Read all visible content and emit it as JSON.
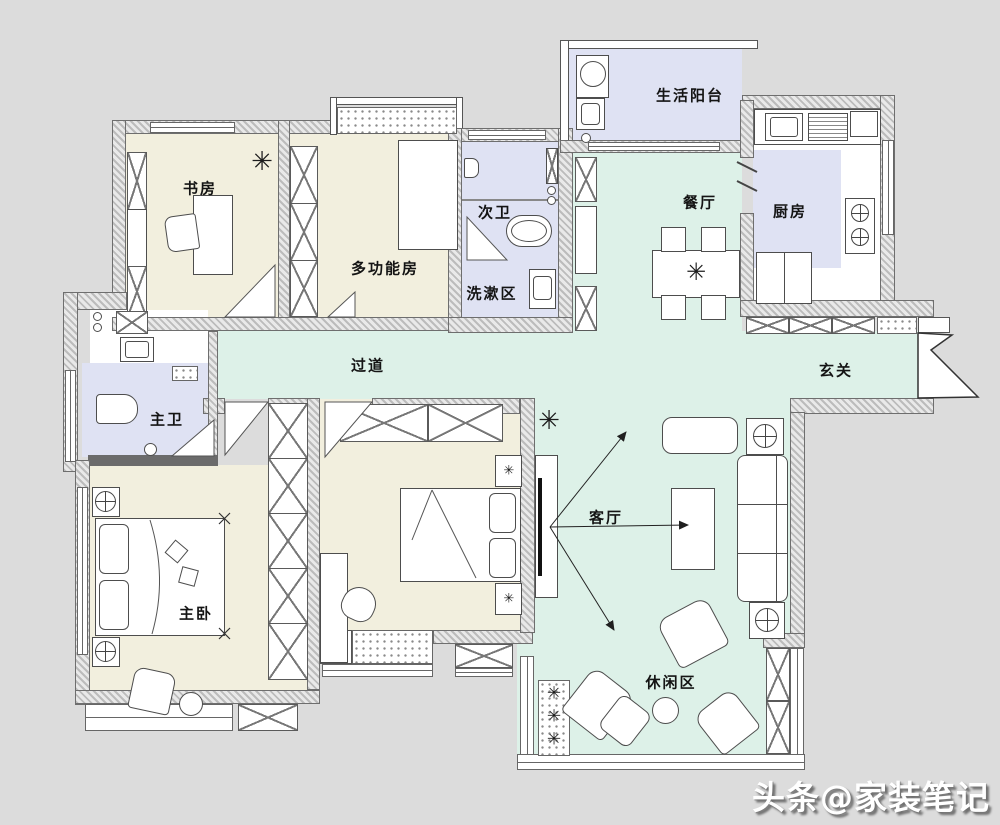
{
  "canvas": {
    "width": 1000,
    "height": 825
  },
  "colors": {
    "background": "#dcdcdc",
    "public_floor": "#ddf1e8",
    "bedroom_floor": "#f2efde",
    "wet_floor": "#dfe2f3",
    "wall_hatch": "#bcbcbc",
    "line": "#4d4d4d"
  },
  "rooms": {
    "study": {
      "label": "书房"
    },
    "multi": {
      "label": "多功能房"
    },
    "bath2": {
      "label": "次卫"
    },
    "wash": {
      "label": "洗漱区"
    },
    "service_balcony": {
      "label": "生活阳台"
    },
    "dining": {
      "label": "餐厅"
    },
    "kitchen": {
      "label": "厨房"
    },
    "hallway": {
      "label": "过道"
    },
    "foyer": {
      "label": "玄关"
    },
    "bath1": {
      "label": "主卫"
    },
    "master": {
      "label": "主卧"
    },
    "living": {
      "label": "客厅"
    },
    "leisure": {
      "label": "休闲区"
    }
  },
  "icons": {
    "plant": "✳"
  },
  "watermark": {
    "text": "头条@家装笔记"
  }
}
